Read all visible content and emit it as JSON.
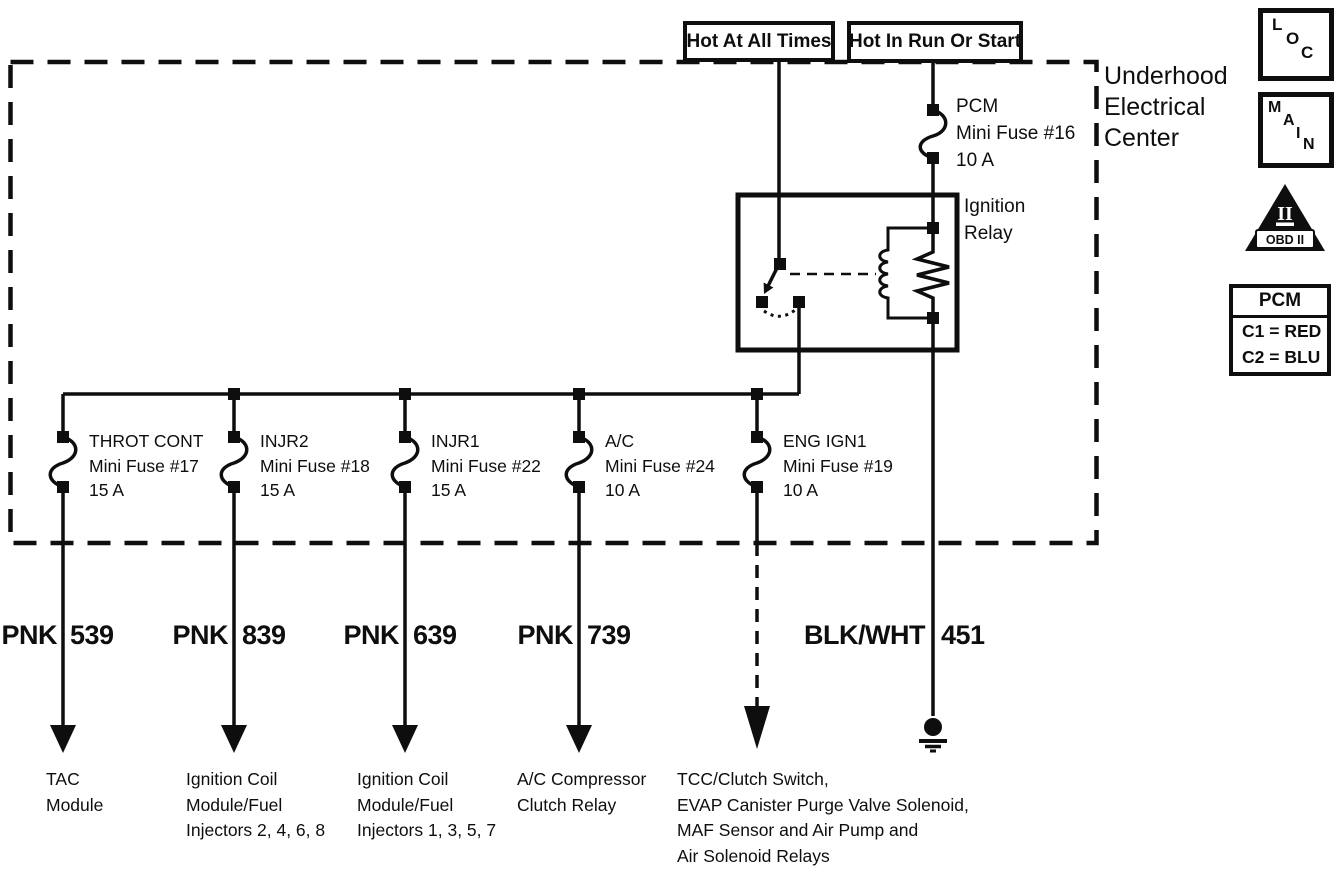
{
  "ink": "#0e0e0e",
  "header": {
    "power_sources": [
      "Hot At All Times",
      "Hot In Run Or Start"
    ],
    "center_title_lines": [
      "Underhood",
      "Electrical",
      "Center"
    ]
  },
  "pcm_fuse": {
    "name": "PCM",
    "fuse": "Mini Fuse #16",
    "rating": "10 A"
  },
  "relay": {
    "name_line1": "Ignition",
    "name_line2": "Relay"
  },
  "fuses": [
    {
      "name": "THROT CONT",
      "fuse": "Mini Fuse #17",
      "rating": "15 A"
    },
    {
      "name": "INJR2",
      "fuse": "Mini Fuse #18",
      "rating": "15 A"
    },
    {
      "name": "INJR1",
      "fuse": "Mini Fuse #22",
      "rating": "15 A"
    },
    {
      "name": "A/C",
      "fuse": "Mini Fuse #24",
      "rating": "10 A"
    },
    {
      "name": "ENG IGN1",
      "fuse": "Mini Fuse #19",
      "rating": "10 A"
    }
  ],
  "wires": [
    {
      "color": "PNK",
      "circuit": "539"
    },
    {
      "color": "PNK",
      "circuit": "839"
    },
    {
      "color": "PNK",
      "circuit": "639"
    },
    {
      "color": "PNK",
      "circuit": "739"
    },
    {
      "color": "BLK/WHT",
      "circuit": "451"
    }
  ],
  "destinations": [
    {
      "lines": [
        "TAC",
        "Module"
      ]
    },
    {
      "lines": [
        "Ignition Coil",
        "Module/Fuel",
        "Injectors 2, 4, 6, 8"
      ]
    },
    {
      "lines": [
        "Ignition Coil",
        "Module/Fuel",
        "Injectors 1, 3, 5, 7"
      ]
    },
    {
      "lines": [
        "A/C Compressor",
        "Clutch Relay"
      ]
    },
    {
      "lines": [
        "TCC/Clutch Switch,",
        "EVAP Canister Purge Valve Solenoid,",
        "MAF Sensor and Air Pump and",
        "Air Solenoid Relays"
      ]
    }
  ],
  "legend": {
    "loc_letters": [
      "L",
      "O",
      "C"
    ],
    "main_letters": [
      "M",
      "A",
      "I",
      "N"
    ],
    "obd": {
      "numeral": "II",
      "label": "OBD II"
    },
    "pcm_connector": {
      "title": "PCM",
      "rows": [
        "C1 = RED",
        "C2 = BLU"
      ]
    }
  }
}
